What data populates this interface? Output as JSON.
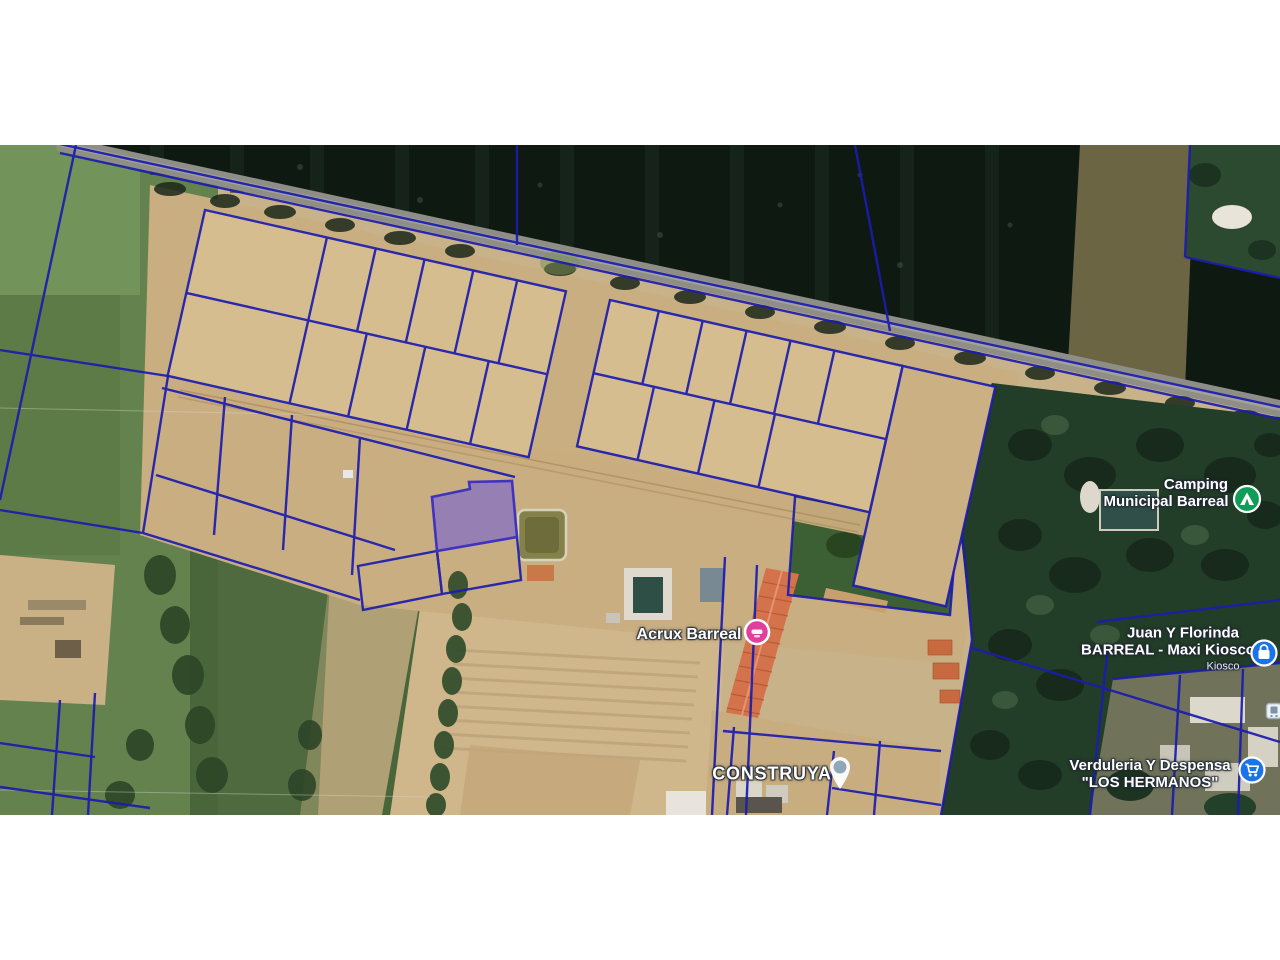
{
  "window": {
    "background": "#ffffff",
    "letterbox_top_px": 145,
    "letterbox_bottom_px": 145
  },
  "map": {
    "kind": "satellite-cadastral-view",
    "colors": {
      "parcel_line": "#1c1cae",
      "highlight_parcel_fill": "#7460d4",
      "highlight_parcel_border": "#4033c0",
      "forest": "#0e1912",
      "dirt": "#cdb489",
      "field_green": "#5f7d4a",
      "road": "#8f8e86",
      "poi_green": "#0f9d58",
      "poi_pink": "#df3f9d",
      "poi_blue": "#1a73e8",
      "pin_grey_blue": "#8fa7b8"
    },
    "pois": [
      {
        "name": "Camping Municipal Barreal",
        "lines": [
          "Camping",
          "Municipal Barreal"
        ],
        "icon": "tent-icon",
        "icon_color": "#0f9d58"
      },
      {
        "name": "Acrux Barreal",
        "lines": [
          "Acrux Barreal"
        ],
        "icon": "pink-circle-marker",
        "icon_color": "#df3f9d"
      },
      {
        "name": "CONSTRUYA",
        "lines": [
          "CONSTRUYA"
        ],
        "icon": "map-pin-icon",
        "icon_color": "#8fa7b8"
      },
      {
        "name": "Juan Y Florinda BARREAL - Maxi Kiosco",
        "lines": [
          "Juan Y Florinda",
          "BARREAL - Maxi Kiosco"
        ],
        "sublabel": "Kiosco",
        "icon": "shop-bag-icon",
        "icon_color": "#1a73e8"
      },
      {
        "name": "Verduleria Y Despensa LOS HERMANOS",
        "lines": [
          "Verduleria Y Despensa",
          "\"LOS HERMANOS\""
        ],
        "icon": "shopping-cart-icon",
        "icon_color": "#1a73e8"
      },
      {
        "name": "transit-stop",
        "lines": [],
        "icon": "transit-stop-icon",
        "icon_color": "#eef2f5"
      }
    ]
  }
}
